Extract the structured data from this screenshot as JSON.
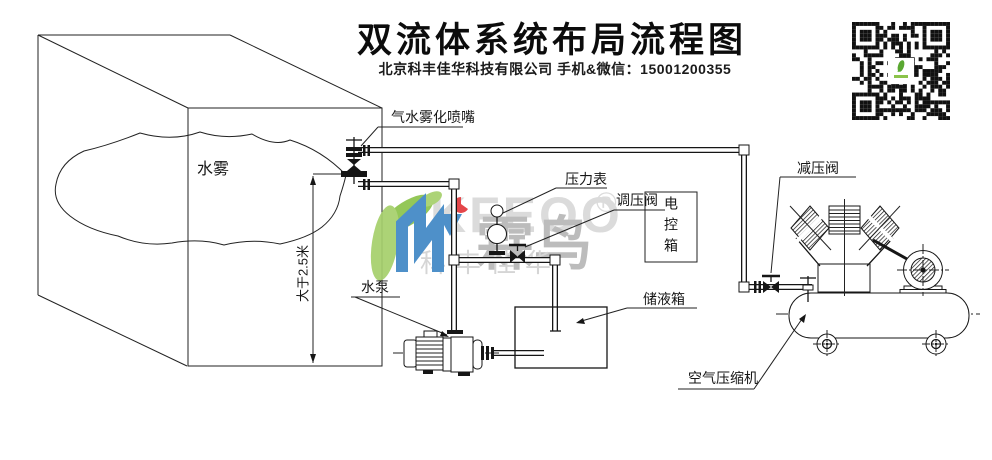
{
  "page": {
    "background": "#ffffff",
    "ink": "#161616"
  },
  "header": {
    "title": "双流体系统布局流程图",
    "subtitle": "北京科丰佳华科技有限公司 手机&微信：15001200355"
  },
  "labels": {
    "mist": "水雾",
    "nozzle": "气水雾化喷嘴",
    "pressure_gauge": "压力表",
    "regulating_valve": "调压阀",
    "control_box": "电控箱",
    "storage_tank": "储液箱",
    "reducing_valve": "减压阀",
    "water_pump": "水泵",
    "air_compressor": "空气压缩机",
    "height_dimension": "大于2.5米"
  },
  "watermark": {
    "brand_latin": "KFEOO",
    "registered": "®",
    "brand_cn": "霖鸟",
    "sub_cn": "科丰佳华",
    "colors": {
      "green": "#8bc34a",
      "green2": "#a5d06b",
      "blue": "#3f87c5",
      "red": "#e2373b",
      "gray_latin": "#d9d9d9",
      "gray_cn": "#b7b7b7",
      "gray_sub": "#d2d2d2"
    }
  }
}
